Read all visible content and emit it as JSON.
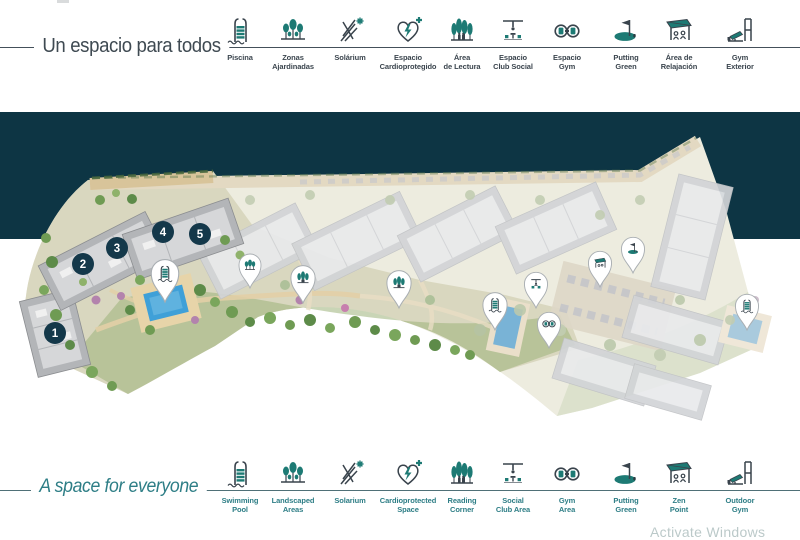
{
  "colors": {
    "accent_teal": "#1d7a74",
    "label_dark": "#3b454e",
    "label_teal": "#2e7e86",
    "band_dark": "#0d3544",
    "marker_navy": "#14384a"
  },
  "top_legend": {
    "title": "Un espacio para todos",
    "items": [
      {
        "id": "piscina",
        "icon": "pool-ladder-icon",
        "lines": [
          "Piscina"
        ]
      },
      {
        "id": "zonas-ajardinadas",
        "icon": "trees-icon",
        "lines": [
          "Zonas",
          "Ajardinadas"
        ]
      },
      {
        "id": "solarium",
        "icon": "deckchair-icon",
        "lines": [
          "Solárium"
        ]
      },
      {
        "id": "espacio-cardioprotegido",
        "icon": "heart-plus-icon",
        "lines": [
          "Espacio",
          "Cardioprotegido"
        ]
      },
      {
        "id": "area-de-lectura",
        "icon": "reading-icon",
        "lines": [
          "Área",
          "de Lectura"
        ]
      },
      {
        "id": "espacio-club-social",
        "icon": "pergola-icon",
        "lines": [
          "Espacio",
          "Club Social"
        ]
      },
      {
        "id": "espacio-gym",
        "icon": "dumbbell-icon",
        "lines": [
          "Espacio",
          "Gym"
        ]
      },
      {
        "id": "putting-green",
        "icon": "putting-icon",
        "lines": [
          "Putting",
          "Green"
        ]
      },
      {
        "id": "area-de-relajacion",
        "icon": "awning-icon",
        "lines": [
          "Área de",
          "Relajación"
        ]
      },
      {
        "id": "gym-exterior",
        "icon": "gym-machine-icon",
        "lines": [
          "Gym",
          "Exterior"
        ]
      }
    ]
  },
  "bottom_legend": {
    "title": "A space for everyone",
    "items": [
      {
        "id": "swimming-pool",
        "icon": "pool-ladder-icon",
        "lines": [
          "Swimming",
          "Pool"
        ]
      },
      {
        "id": "landscaped-areas",
        "icon": "trees-icon",
        "lines": [
          "Landscaped",
          "Areas"
        ]
      },
      {
        "id": "solarium",
        "icon": "deckchair-icon",
        "lines": [
          "Solarium"
        ]
      },
      {
        "id": "cardioprotected-space",
        "icon": "heart-plus-icon",
        "lines": [
          "Cardioprotected",
          "Space"
        ]
      },
      {
        "id": "reading-corner",
        "icon": "reading-icon",
        "lines": [
          "Reading",
          "Corner"
        ]
      },
      {
        "id": "social-club-area",
        "icon": "pergola-icon",
        "lines": [
          "Social",
          "Club Area"
        ]
      },
      {
        "id": "gym-area",
        "icon": "dumbbell-icon",
        "lines": [
          "Gym",
          "Area"
        ]
      },
      {
        "id": "putting-green",
        "icon": "putting-icon",
        "lines": [
          "Putting",
          "Green"
        ]
      },
      {
        "id": "zen-point",
        "icon": "awning-icon",
        "lines": [
          "Zen",
          "Point"
        ]
      },
      {
        "id": "outdoor-gym",
        "icon": "gym-machine-icon",
        "lines": [
          "Outdoor",
          "Gym"
        ]
      }
    ]
  },
  "map": {
    "buildings": [
      {
        "number": "1",
        "x": 55,
        "y": 333
      },
      {
        "number": "2",
        "x": 83,
        "y": 264
      },
      {
        "number": "3",
        "x": 117,
        "y": 248
      },
      {
        "number": "4",
        "x": 163,
        "y": 232
      },
      {
        "number": "5",
        "x": 200,
        "y": 234
      }
    ],
    "pins": [
      {
        "id": "pin-pool-main",
        "icon": "pool-ladder-icon",
        "x": 165,
        "y": 302,
        "s": 1.25
      },
      {
        "id": "pin-trees-1",
        "icon": "trees-icon",
        "x": 250,
        "y": 288,
        "s": 1.0
      },
      {
        "id": "pin-reading-1",
        "icon": "reading-icon",
        "x": 303,
        "y": 303,
        "s": 1.1
      },
      {
        "id": "pin-reading-2",
        "icon": "reading-icon",
        "x": 399,
        "y": 308,
        "s": 1.1
      },
      {
        "id": "pin-pool-2",
        "icon": "pool-ladder-icon",
        "x": 495,
        "y": 330,
        "s": 1.1
      },
      {
        "id": "pin-social-club",
        "icon": "pergola-icon",
        "x": 536,
        "y": 308,
        "s": 1.05
      },
      {
        "id": "pin-gym",
        "icon": "dumbbell-icon",
        "x": 549,
        "y": 348,
        "s": 1.05
      },
      {
        "id": "pin-zen",
        "icon": "awning-icon",
        "x": 600,
        "y": 287,
        "s": 1.05
      },
      {
        "id": "pin-putting",
        "icon": "putting-icon",
        "x": 633,
        "y": 273,
        "s": 1.05
      },
      {
        "id": "pin-pool-3",
        "icon": "pool-ladder-icon",
        "x": 747,
        "y": 330,
        "s": 1.05
      }
    ]
  },
  "watermark": {
    "text": "Activate Windows"
  }
}
